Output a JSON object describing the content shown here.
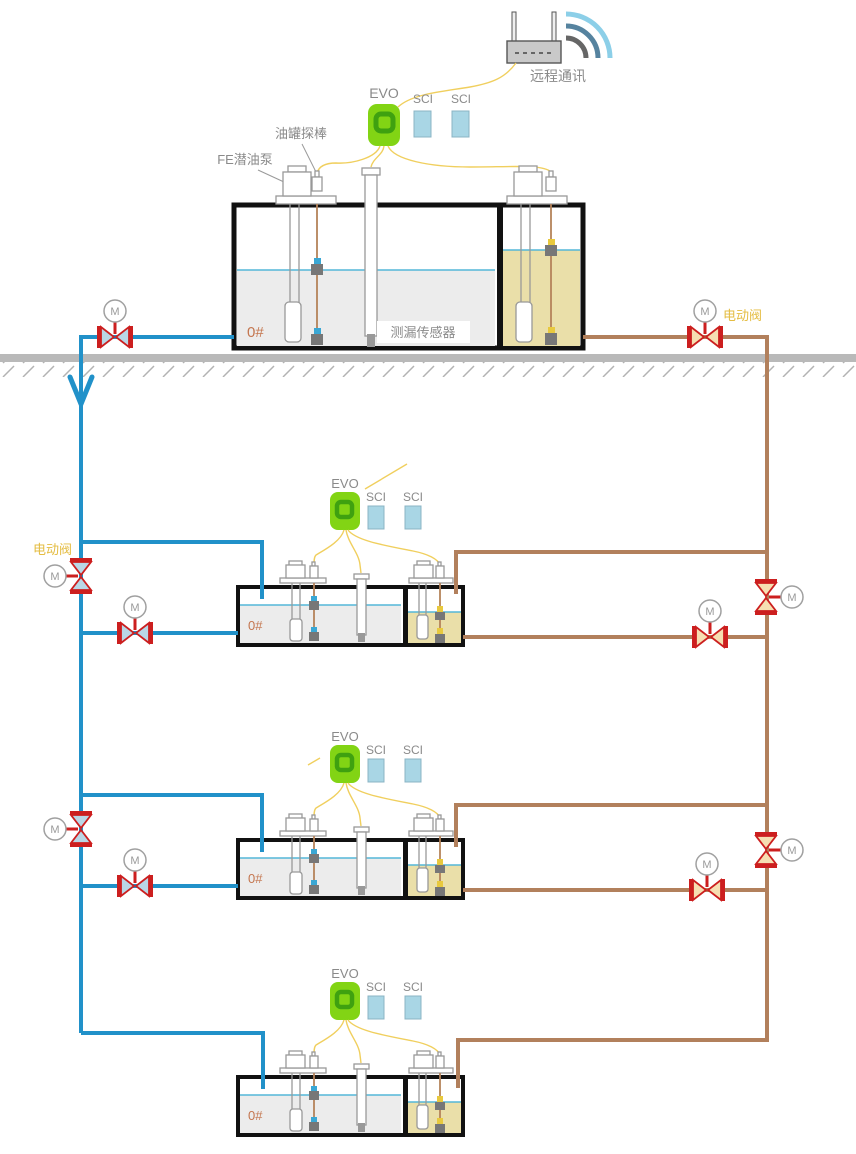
{
  "labels": {
    "remote_comm": "远程通讯",
    "evo": "EVO",
    "sci": "SCI",
    "tank_probe": "油罐探棒",
    "fe_pump": "FE潜油泵",
    "leak_sensor": "测漏传感器",
    "grade": "0#",
    "electric_valve": "电动阀",
    "motor": "M"
  },
  "tank_grades": [
    "0#",
    "0#",
    "0#",
    "0#"
  ],
  "colors": {
    "pipe_supply": "#2191c9",
    "pipe_return": "#b2805c",
    "wire": "#f0cf5e",
    "valve_red": "#cc1f1f",
    "valve_fill_blue": "#b9d7e6",
    "valve_fill_tan": "#f6dfb2",
    "evo_green": "#82d414",
    "evo_green_dark": "#3fa110",
    "sci_blue": "#a9d6e5",
    "sci_border": "#8bb4c4",
    "liquid_gray": "#ececec",
    "liquid_khaki": "#eadfa9",
    "liquid_line": "#54b7d8",
    "ground_gray": "#b9b9b9",
    "label_gray": "#8a8a8a",
    "grade_orange": "#c4764f",
    "valve_label_yellow": "#e4bc41",
    "probe_brown": "#b5835a",
    "float_blue": "#3aa7d4",
    "float_yellow": "#e8c93e"
  }
}
